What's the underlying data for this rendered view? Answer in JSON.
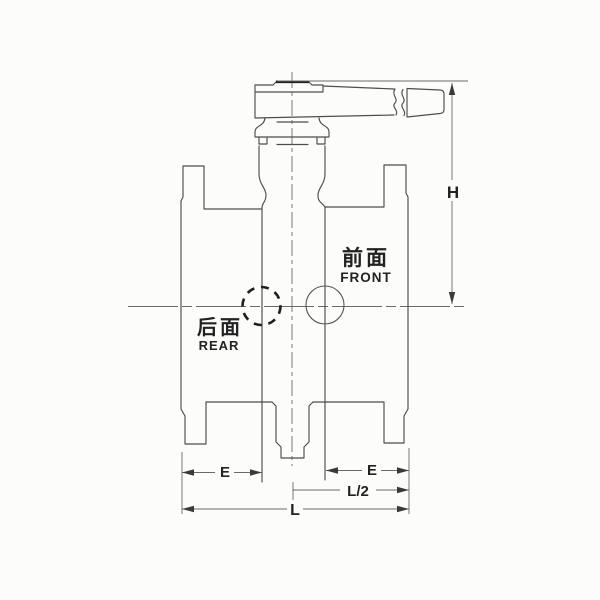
{
  "diagram": {
    "annotations": {
      "front_cn": "前面",
      "front_en": "FRONT",
      "rear_cn": "后面",
      "rear_en": "REAR"
    },
    "dimensions": {
      "height_label": "H",
      "e_left_label": "E",
      "e_right_label": "E",
      "half_length_label": "L/2",
      "length_label": "L"
    },
    "colors": {
      "line": "#4d4d4d",
      "bold_line": "#1f1f1f",
      "text": "#222222",
      "background": "#fcfcfb"
    }
  }
}
